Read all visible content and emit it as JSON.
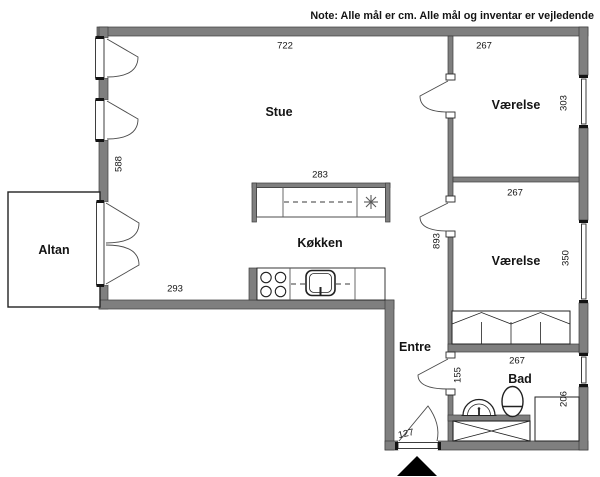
{
  "note": "Note: Alle mål er cm. Alle mål og inventar er vejledende",
  "rooms": {
    "stue": "Stue",
    "koekken": "Køkken",
    "altan": "Altan",
    "vaerelse_top": "Værelse",
    "vaerelse_mid": "Værelse",
    "entre": "Entre",
    "bad": "Bad"
  },
  "dimensions": {
    "stue_width": "722",
    "stue_depth": "588",
    "island_width": "283",
    "kitchen_wall": "293",
    "vaerelse_top_width": "267",
    "vaerelse_top_depth": "303",
    "vaerelse_mid_width": "267",
    "vaerelse_mid_depth": "350",
    "hall_depth": "893",
    "bad_width": "267",
    "bad_depth": "206",
    "bad_wall": "155",
    "entrance_width": "127"
  },
  "colors": {
    "wall": "#7f7f7f",
    "wall_outline": "#3d3d3d",
    "line": "#222222",
    "background": "#ffffff"
  }
}
